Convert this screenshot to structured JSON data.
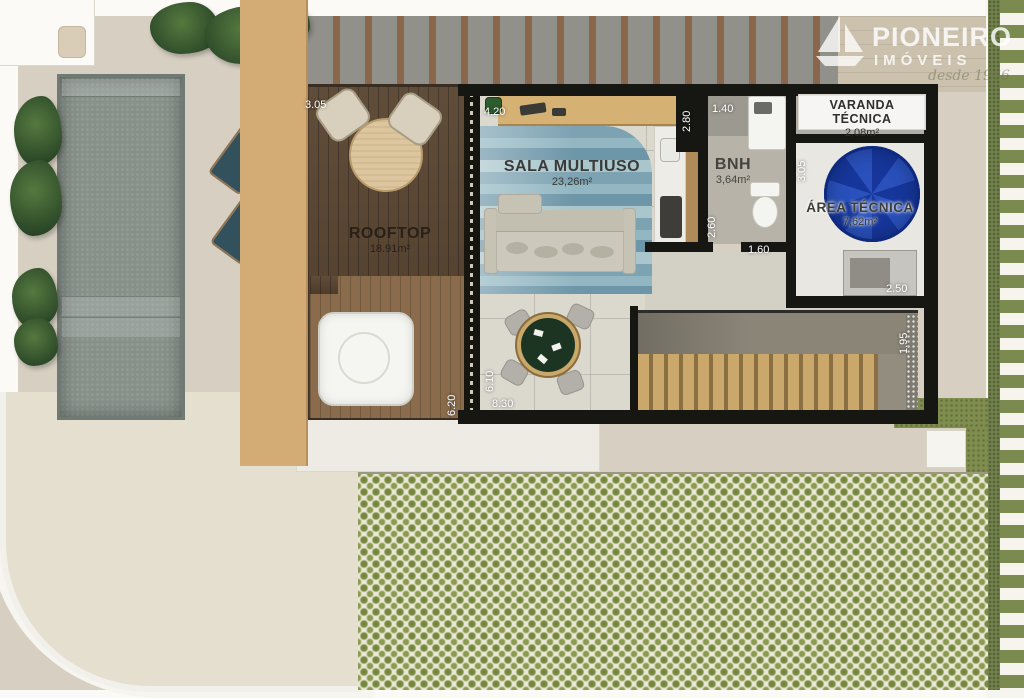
{
  "logo": {
    "brand": "PIONEIRO",
    "brand_sub": "IMÓVEIS",
    "tagline": "desde 1966",
    "icon": "sailboat-icon"
  },
  "rooms": {
    "rooftop": {
      "name": "ROOFTOP",
      "area": "18.91m²"
    },
    "sala": {
      "name": "SALA MULTIUSO",
      "area": "23,26m²"
    },
    "bnh": {
      "name": "BNH",
      "area": "3,64m²"
    },
    "varanda": {
      "name": "VARANDA TÉCNICA",
      "area": "2,08m²"
    },
    "area_tecnica": {
      "name": "ÁREA TÉCNICA",
      "area": "7,62m²"
    }
  },
  "dimensions": {
    "rooftop_width": "3.05",
    "sala_width": "4.20",
    "kitchen_depth": "2.80",
    "bnh_width": "1.40",
    "bnh_depth": "2.60",
    "hall_width": "1.60",
    "area_tecnica_depth": "3.05",
    "area_tecnica_width": "2.50",
    "stair_depth": "1.95",
    "sala_depth": "6.10",
    "rooftop_depth": "6.20",
    "building_length": "8.30"
  },
  "colors": {
    "wall": "#161613",
    "deck_wood": "#57432f",
    "pool_water": "#87918a",
    "rug_blue": "#7da2b2",
    "tank_blue": "#16369b",
    "trellis_green": "#7b8a4f",
    "ground_beige": "#d7d0c2"
  }
}
